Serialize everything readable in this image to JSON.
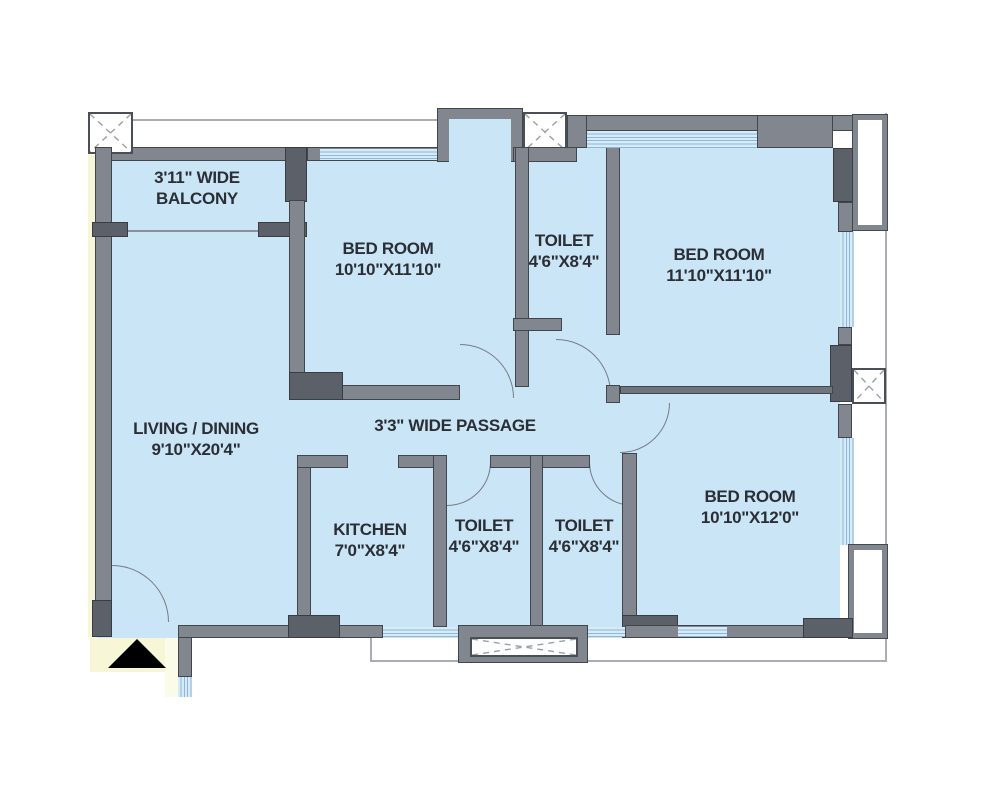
{
  "plan": {
    "title": "3 BHK apartment floor plan",
    "rooms": [
      {
        "id": "balcony",
        "line1": "3'11\" WIDE",
        "line2": "BALCONY"
      },
      {
        "id": "bedroom-1",
        "line1": "BED ROOM",
        "line2": "10'10\"X11'10\""
      },
      {
        "id": "toilet-1",
        "line1": "TOILET",
        "line2": "4'6\"X8'4\""
      },
      {
        "id": "bedroom-2",
        "line1": "BED ROOM",
        "line2": "11'10\"X11'10\""
      },
      {
        "id": "living-dining",
        "line1": "LIVING / DINING",
        "line2": "9'10\"X20'4\""
      },
      {
        "id": "passage",
        "line1": "3'3\" WIDE PASSAGE",
        "line2": ""
      },
      {
        "id": "kitchen",
        "line1": "KITCHEN",
        "line2": "7'0\"X8'4\""
      },
      {
        "id": "toilet-2",
        "line1": "TOILET",
        "line2": "4'6\"X8'4\""
      },
      {
        "id": "toilet-3",
        "line1": "TOILET",
        "line2": "4'6\"X8'4\""
      },
      {
        "id": "bedroom-3",
        "line1": "BED ROOM",
        "line2": "10'10\"X12'0\""
      }
    ],
    "colors": {
      "room_fill": "#c9e5f6",
      "wall": "#82878f",
      "wall_dark": "#5b6069",
      "window": "#8fb6d4",
      "outside_common_area": "#f7f7d8",
      "entry_arrow": "#000000"
    }
  }
}
